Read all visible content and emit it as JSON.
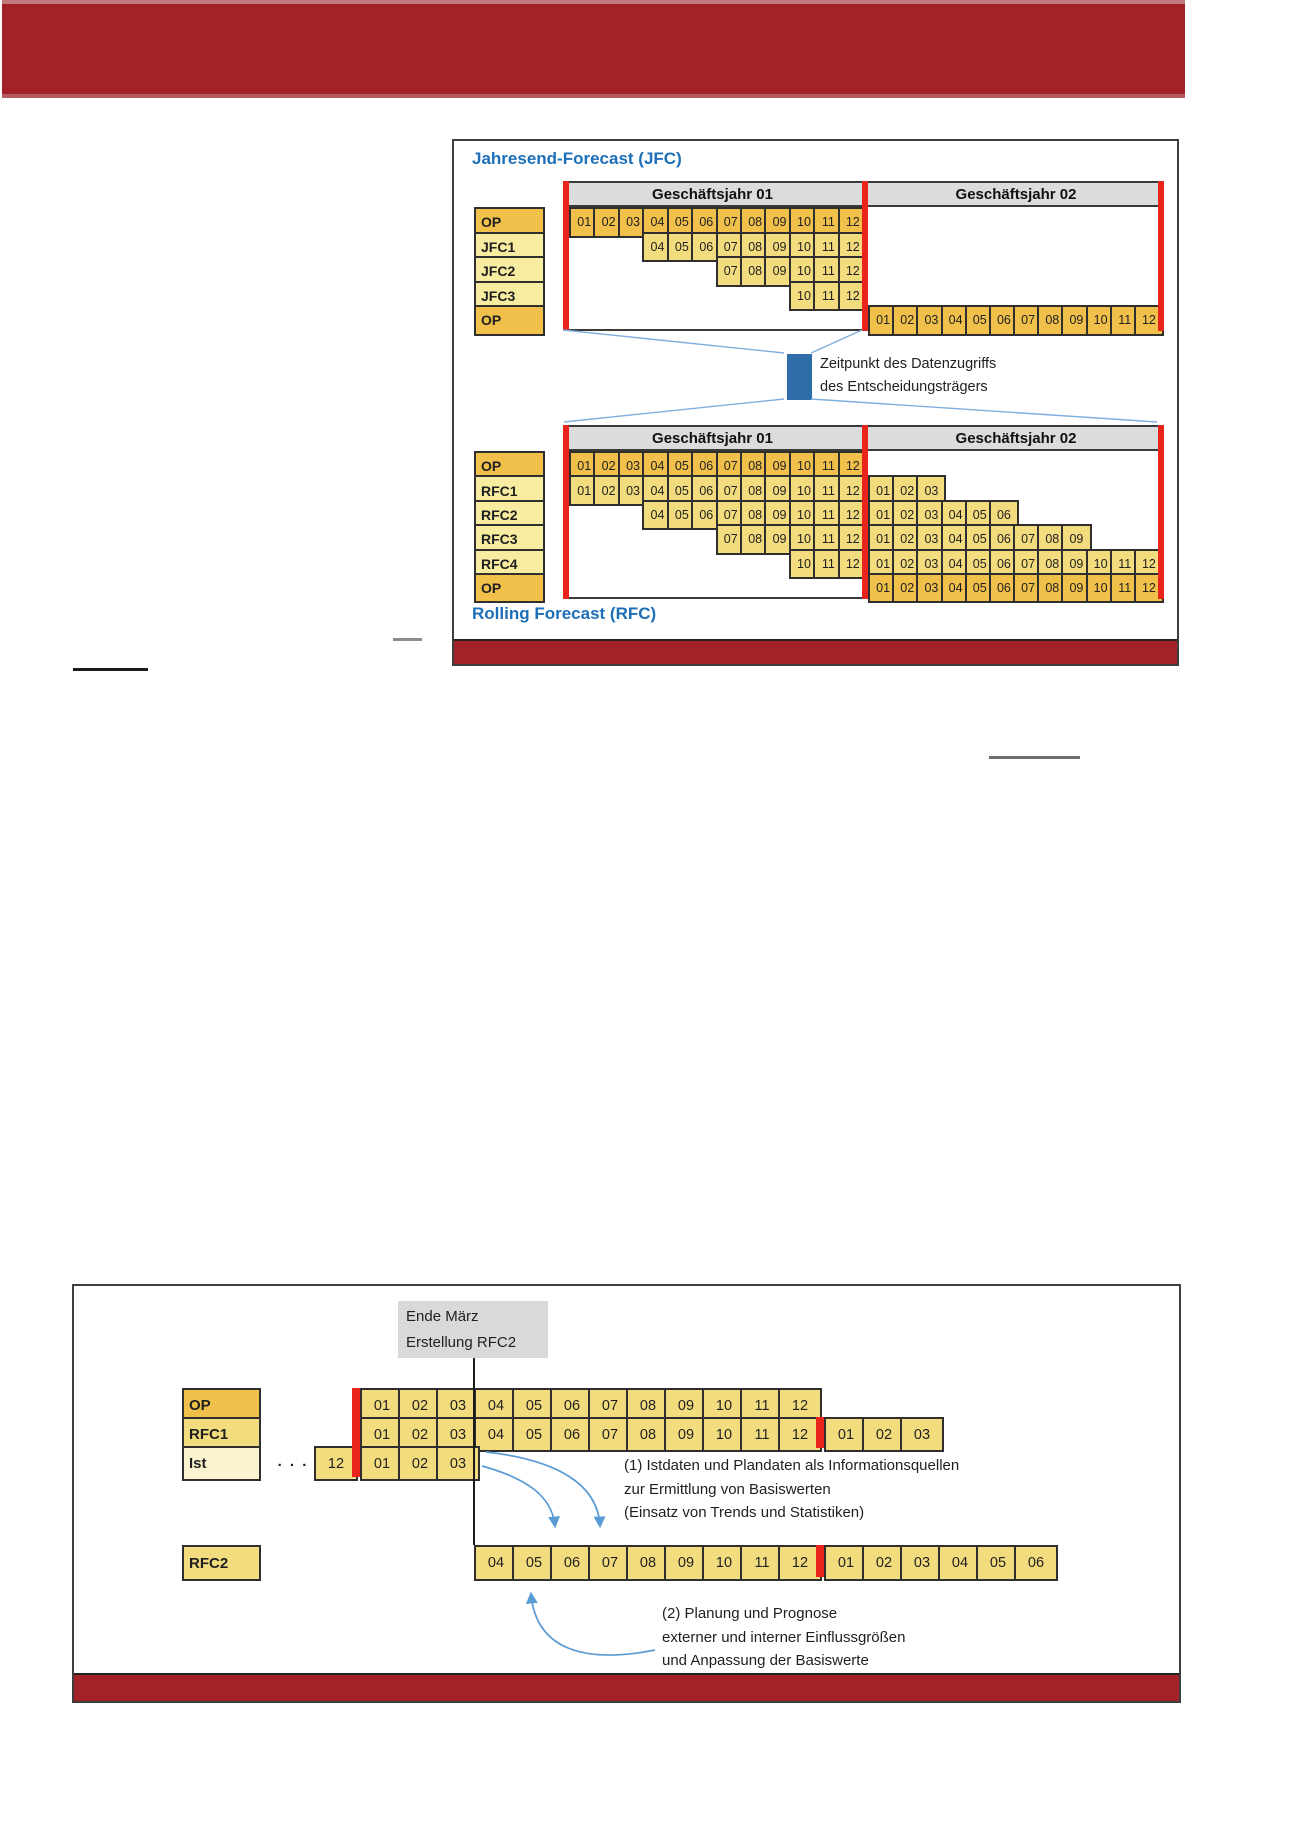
{
  "colors": {
    "banner_red": "#A32228",
    "bar_red": "#E8241C",
    "cell_orange": "#F0C04B",
    "cell_yellow": "#F2DC7E",
    "label_pale": "#F7EC9F",
    "label_ist": "#FBF3D0",
    "header_gray": "#DCDCDC",
    "event_gray": "#D9D9D9",
    "title_blue": "#1D6FB8",
    "callout_blue": "#2E6DA8",
    "connector_blue": "#7FAFDF",
    "arrow_blue": "#5B9BD5",
    "border_dark": "#2F2F2F",
    "text_dark": "#1F1F1F"
  },
  "figure1": {
    "title": "Jahresend-Forecast (JFC)",
    "subtitle": "Rolling Forecast (RFC)",
    "year1_header": "Geschäftsjahr 01",
    "year2_header": "Geschäftsjahr 02",
    "callout": {
      "line1": "Zeitpunkt des Datenzugriffs",
      "line2": "des Entscheidungsträgers"
    },
    "jfc_table": {
      "rows": [
        {
          "label": "OP",
          "type": "op",
          "year1": [
            "01",
            "02",
            "03",
            "04",
            "05",
            "06",
            "07",
            "08",
            "09",
            "10",
            "11",
            "12"
          ],
          "year2": []
        },
        {
          "label": "JFC1",
          "type": "forecast",
          "year1": [
            "04",
            "05",
            "06",
            "07",
            "08",
            "09",
            "10",
            "11",
            "12"
          ],
          "year2": []
        },
        {
          "label": "JFC2",
          "type": "forecast",
          "year1": [
            "07",
            "08",
            "09",
            "10",
            "11",
            "12"
          ],
          "year2": []
        },
        {
          "label": "JFC3",
          "type": "forecast",
          "year1": [
            "10",
            "11",
            "12"
          ],
          "year2": []
        },
        {
          "label": "OP",
          "type": "op",
          "year1": [],
          "year2": [
            "01",
            "02",
            "03",
            "04",
            "05",
            "06",
            "07",
            "08",
            "09",
            "10",
            "11",
            "12"
          ]
        }
      ]
    },
    "rfc_table": {
      "rows": [
        {
          "label": "OP",
          "type": "op",
          "year1": [
            "01",
            "02",
            "03",
            "04",
            "05",
            "06",
            "07",
            "08",
            "09",
            "10",
            "11",
            "12"
          ],
          "year2": []
        },
        {
          "label": "RFC1",
          "type": "forecast",
          "year1": [
            "01",
            "02",
            "03",
            "04",
            "05",
            "06",
            "07",
            "08",
            "09",
            "10",
            "11",
            "12"
          ],
          "year2": [
            "01",
            "02",
            "03"
          ]
        },
        {
          "label": "RFC2",
          "type": "forecast",
          "year1": [
            "04",
            "05",
            "06",
            "07",
            "08",
            "09",
            "10",
            "11",
            "12"
          ],
          "year2": [
            "01",
            "02",
            "03",
            "04",
            "05",
            "06"
          ]
        },
        {
          "label": "RFC3",
          "type": "forecast",
          "year1": [
            "07",
            "08",
            "09",
            "10",
            "11",
            "12"
          ],
          "year2": [
            "01",
            "02",
            "03",
            "04",
            "05",
            "06",
            "07",
            "08",
            "09"
          ]
        },
        {
          "label": "RFC4",
          "type": "forecast",
          "year1": [
            "10",
            "11",
            "12"
          ],
          "year2": [
            "01",
            "02",
            "03",
            "04",
            "05",
            "06",
            "07",
            "08",
            "09",
            "10",
            "11",
            "12"
          ]
        },
        {
          "label": "OP",
          "type": "op",
          "year1": [],
          "year2": [
            "01",
            "02",
            "03",
            "04",
            "05",
            "06",
            "07",
            "08",
            "09",
            "10",
            "11",
            "12"
          ]
        }
      ]
    }
  },
  "figure2": {
    "event_label": {
      "line1": "Ende März",
      "line2": "Erstellung RFC2"
    },
    "rows": [
      {
        "label": "OP",
        "type": "op",
        "prefix": null,
        "prev_month": null,
        "months": [
          "01",
          "02",
          "03",
          "04",
          "05",
          "06",
          "07",
          "08",
          "09",
          "10",
          "11",
          "12"
        ],
        "next_year": []
      },
      {
        "label": "RFC1",
        "type": "forecast",
        "prefix": null,
        "prev_month": null,
        "months": [
          "01",
          "02",
          "03",
          "04",
          "05",
          "06",
          "07",
          "08",
          "09",
          "10",
          "11",
          "12"
        ],
        "next_year": [
          "01",
          "02",
          "03"
        ]
      },
      {
        "label": "Ist",
        "type": "actual",
        "prefix": ". . .",
        "prev_month": "12",
        "months": [
          "01",
          "02",
          "03"
        ],
        "next_year": []
      }
    ],
    "rfc2_row": {
      "label": "RFC2",
      "type": "forecast",
      "months": [
        "04",
        "05",
        "06",
        "07",
        "08",
        "09",
        "10",
        "11",
        "12"
      ],
      "next_year": [
        "01",
        "02",
        "03",
        "04",
        "05",
        "06"
      ]
    },
    "note1": {
      "line1": "(1) Istdaten und Plandaten als Informationsquellen",
      "line2": "zur Ermittlung von Basiswerten",
      "line3": "(Einsatz von Trends und Statistiken)"
    },
    "note2": {
      "line1": "(2) Planung und Prognose",
      "line2": "externer und interner Einflussgrößen",
      "line3": "und Anpassung der Basiswerte"
    }
  }
}
